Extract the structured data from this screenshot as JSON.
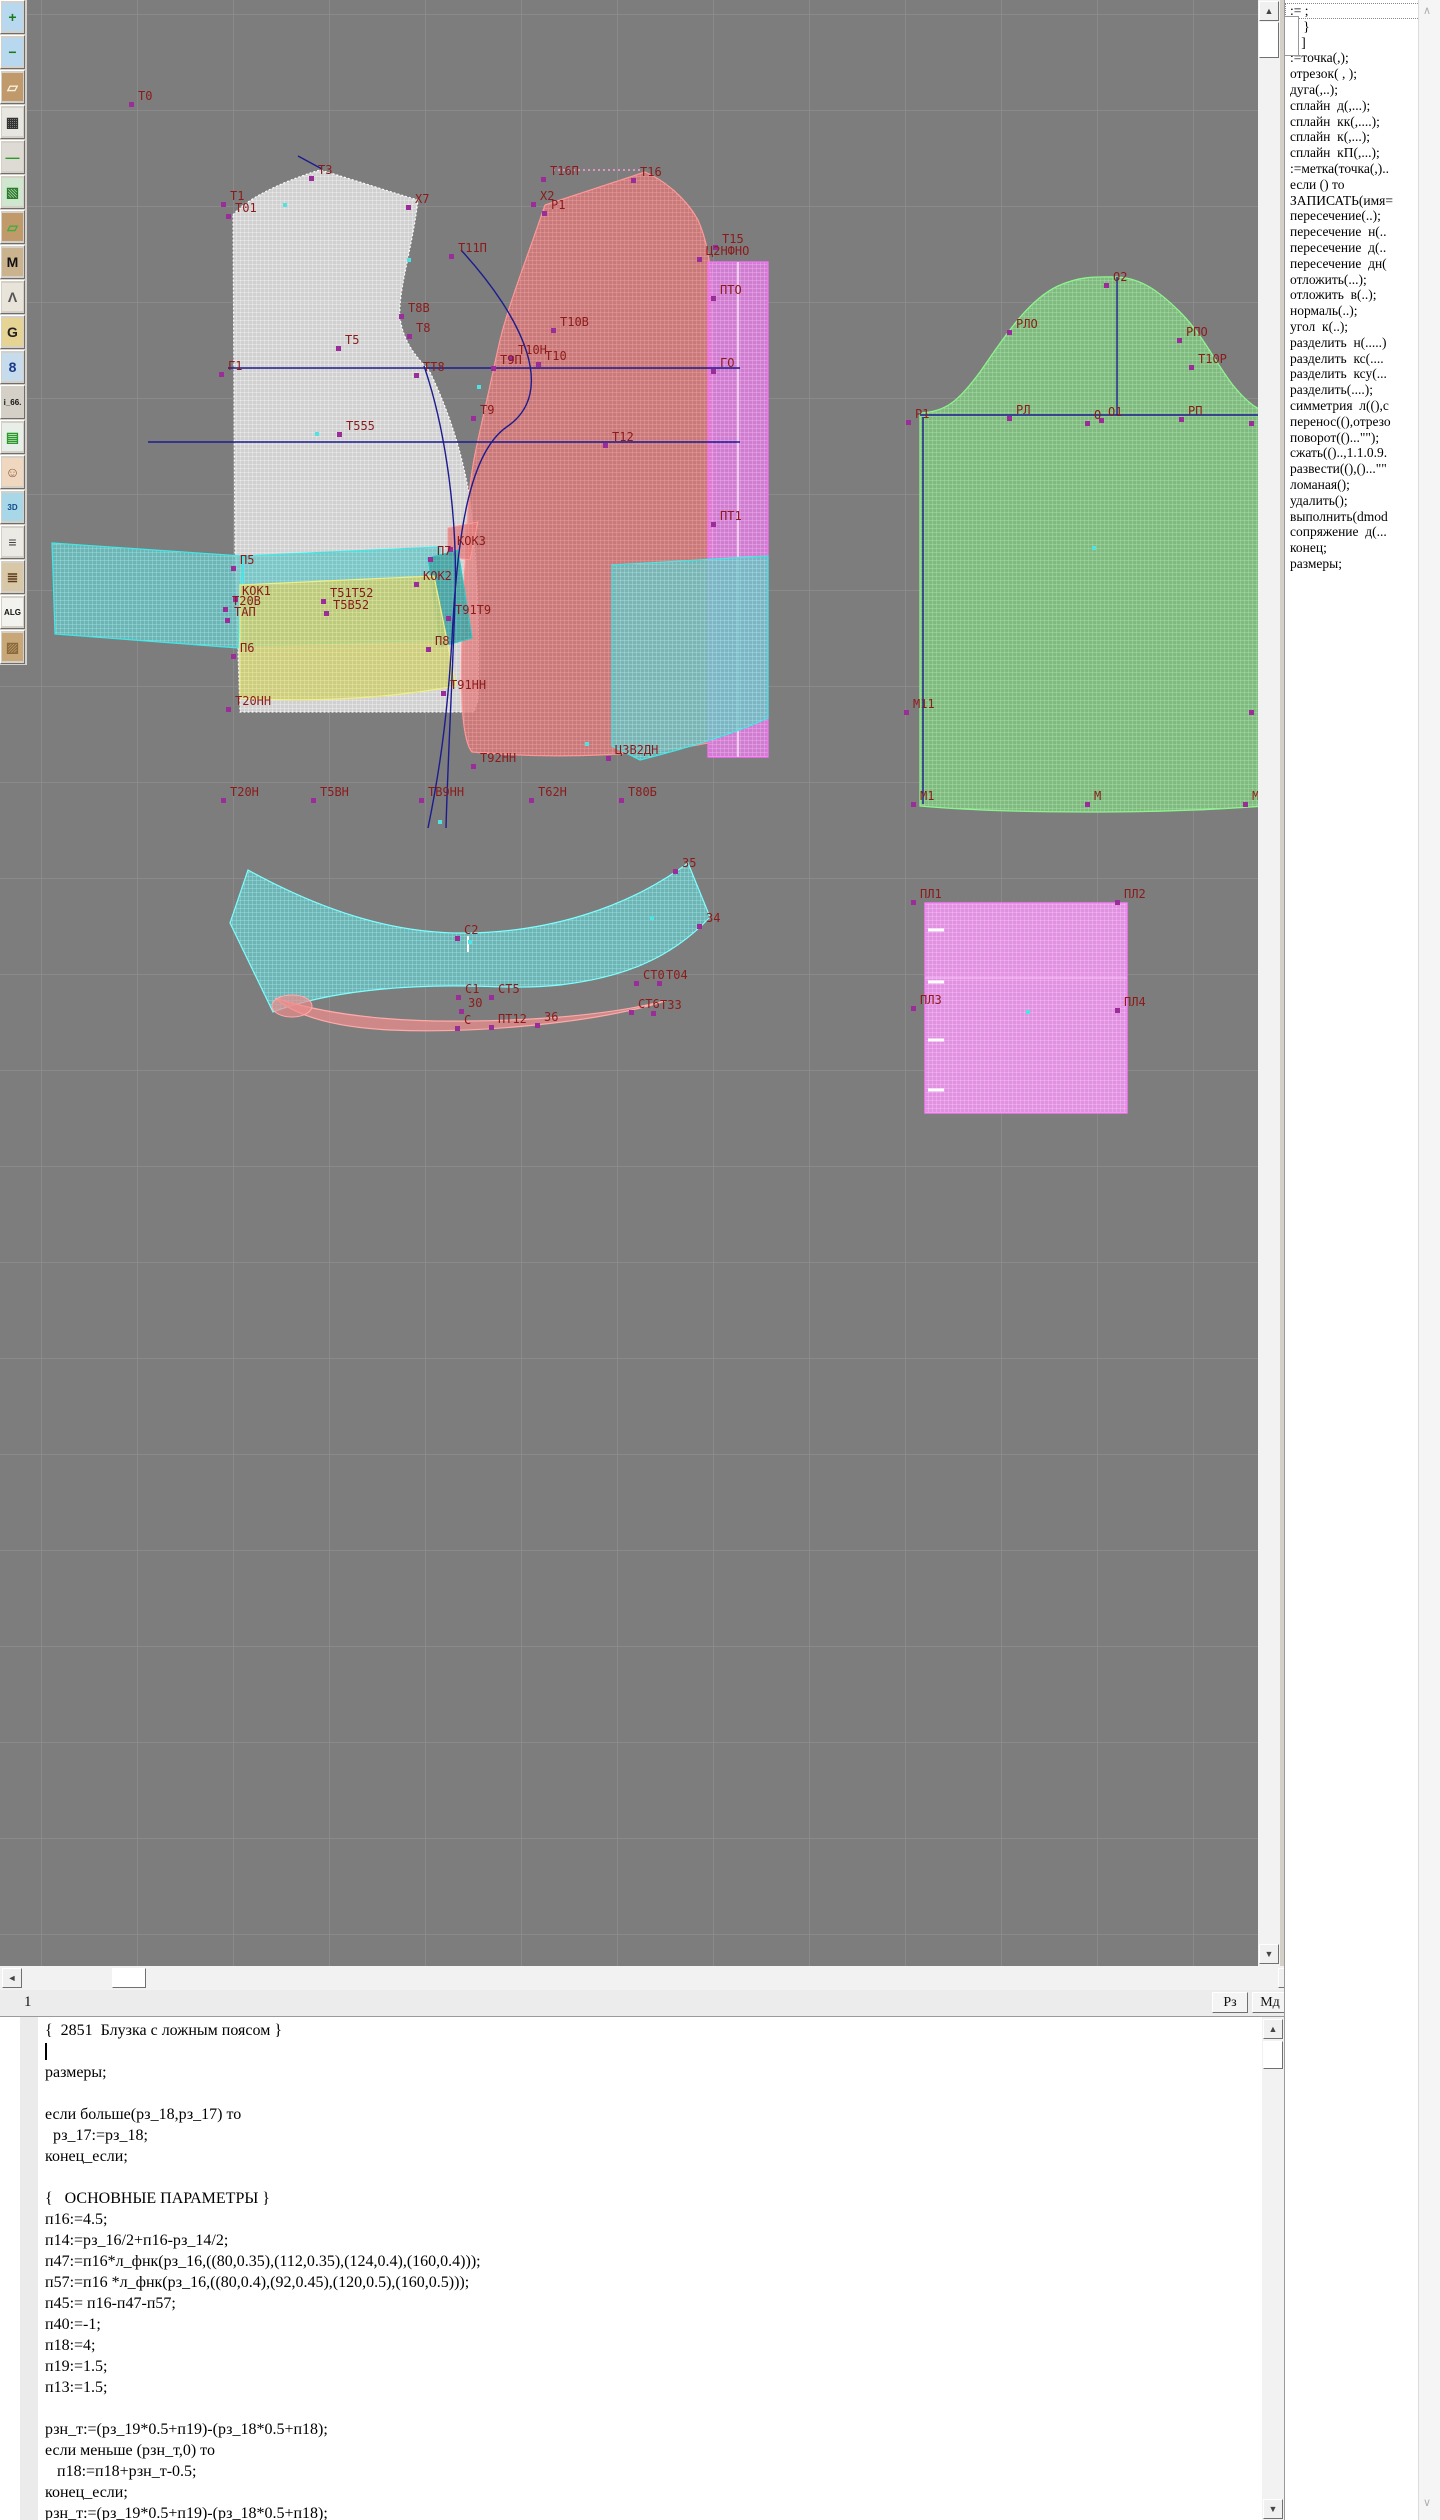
{
  "window": {
    "title": "Грация САПР - конструирование одежды",
    "width": 1440,
    "height": 2520
  },
  "colors": {
    "canvas_bg": "#7d7d7d",
    "grid": "#8a8a8a",
    "label": "#8b1b1b",
    "marker": "#9b2d9b",
    "cyan_dot": "#4fe3e3",
    "blue_line": "#1c1c8f",
    "back_piece": "#f0f0f0",
    "front_piece": "#de7878",
    "sleeve": "#80c480",
    "collar": "#6cc2c2",
    "belt_yellow": "#cccc6c",
    "placket": "#e07ce0",
    "facing": "#ee94ee"
  },
  "toolbar": {
    "items": [
      {
        "name": "zoom-in-icon",
        "label": "+",
        "bg": "#b8d8f0",
        "fg": "#1a7a1a"
      },
      {
        "name": "zoom-out-icon",
        "label": "−",
        "bg": "#b8d8f0",
        "fg": "#1a7a1a"
      },
      {
        "name": "piece-preview-icon",
        "label": "▱",
        "bg": "#c19a6b",
        "fg": "#f5f0e0"
      },
      {
        "name": "grid-icon",
        "label": "▦",
        "bg": "#e8e6e0",
        "fg": "#333333"
      },
      {
        "name": "segment-icon",
        "label": "—",
        "bg": "#dedbd4",
        "fg": "#2a9a2a"
      },
      {
        "name": "sketch-icon",
        "label": "▧",
        "bg": "#cfe6cf",
        "fg": "#2a7a2a"
      },
      {
        "name": "piece-contour-icon",
        "label": "▱",
        "bg": "#c19a6b",
        "fg": "#3fae3f"
      },
      {
        "name": "pattern-m-icon",
        "label": "M",
        "bg": "#cbb390",
        "fg": "#111111"
      },
      {
        "name": "drafting-tools-icon",
        "label": "Λ",
        "bg": "#e8e4da",
        "fg": "#555555"
      },
      {
        "name": "pattern-g-icon",
        "label": "G",
        "bg": "#e6d494",
        "fg": "#222222"
      },
      {
        "name": "blueprint-icon",
        "label": "8",
        "bg": "#c6dcec",
        "fg": "#1a3a8a"
      },
      {
        "name": "i66-button",
        "label": "i_66.",
        "bg": "#d4d0c8",
        "fg": "#111111"
      },
      {
        "name": "table-icon",
        "label": "▤",
        "bg": "#e8efe8",
        "fg": "#2a9a2a"
      },
      {
        "name": "portrait-icon",
        "label": "☺",
        "bg": "#f0d8c0",
        "fg": "#8a5a3a"
      },
      {
        "name": "3d-icon",
        "label": "3D",
        "bg": "#a8d8e8",
        "fg": "#104a8a"
      },
      {
        "name": "list-icon",
        "label": "≡",
        "bg": "#eceae4",
        "fg": "#444444"
      },
      {
        "name": "books-icon",
        "label": "≣",
        "bg": "#d8c8a8",
        "fg": "#5a3a1a"
      },
      {
        "name": "alg-icon",
        "label": "ALG",
        "bg": "#f2f2ee",
        "fg": "#111111"
      },
      {
        "name": "material-icon",
        "label": "▨",
        "bg": "#c8a878",
        "fg": "#8a6a3a"
      }
    ]
  },
  "canvas": {
    "labels": [
      {
        "t": "Т0",
        "x": 138,
        "y": 90
      },
      {
        "t": "Т1",
        "x": 230,
        "y": 190
      },
      {
        "t": "Т01",
        "x": 235,
        "y": 202
      },
      {
        "t": "Т3",
        "x": 318,
        "y": 164
      },
      {
        "t": "Х7",
        "x": 415,
        "y": 193
      },
      {
        "t": "Т11П",
        "x": 458,
        "y": 242
      },
      {
        "t": "Т8В",
        "x": 408,
        "y": 302
      },
      {
        "t": "Т8",
        "x": 416,
        "y": 322
      },
      {
        "t": "Т5",
        "x": 345,
        "y": 334
      },
      {
        "t": "ТТ8",
        "x": 423,
        "y": 361
      },
      {
        "t": "Г1",
        "x": 228,
        "y": 360
      },
      {
        "t": "Т555",
        "x": 346,
        "y": 420
      },
      {
        "t": "Т16П",
        "x": 550,
        "y": 165
      },
      {
        "t": "Т16",
        "x": 640,
        "y": 166
      },
      {
        "t": "Х2",
        "x": 540,
        "y": 190
      },
      {
        "t": "Р1",
        "x": 551,
        "y": 199
      },
      {
        "t": "Т10В",
        "x": 560,
        "y": 316
      },
      {
        "t": "Т10Н",
        "x": 518,
        "y": 344
      },
      {
        "t": "Т10",
        "x": 545,
        "y": 350
      },
      {
        "t": "Т9П",
        "x": 500,
        "y": 354
      },
      {
        "t": "Т9",
        "x": 480,
        "y": 404
      },
      {
        "t": "Т12",
        "x": 612,
        "y": 431
      },
      {
        "t": "Т15",
        "x": 722,
        "y": 233
      },
      {
        "t": "Ц2НФНО",
        "x": 706,
        "y": 245
      },
      {
        "t": "ПТО",
        "x": 720,
        "y": 284
      },
      {
        "t": "ГО",
        "x": 720,
        "y": 357
      },
      {
        "t": "ПТ1",
        "x": 720,
        "y": 510
      },
      {
        "t": "П5",
        "x": 240,
        "y": 554
      },
      {
        "t": "КОК1",
        "x": 242,
        "y": 585
      },
      {
        "t": "Т20В",
        "x": 232,
        "y": 595
      },
      {
        "t": "ТАП",
        "x": 234,
        "y": 606
      },
      {
        "t": "Т51Т52",
        "x": 330,
        "y": 587
      },
      {
        "t": "Т5В52",
        "x": 333,
        "y": 599
      },
      {
        "t": "П7",
        "x": 437,
        "y": 545
      },
      {
        "t": "КОК2",
        "x": 423,
        "y": 570
      },
      {
        "t": "КОК3",
        "x": 457,
        "y": 535
      },
      {
        "t": "Т91Т9",
        "x": 455,
        "y": 604
      },
      {
        "t": "П6",
        "x": 240,
        "y": 642
      },
      {
        "t": "П8",
        "x": 435,
        "y": 635
      },
      {
        "t": "Т91НН",
        "x": 450,
        "y": 679
      },
      {
        "t": "Т20НН",
        "x": 235,
        "y": 695
      },
      {
        "t": "Т92НН",
        "x": 480,
        "y": 752
      },
      {
        "t": "Т20Н",
        "x": 230,
        "y": 786
      },
      {
        "t": "Т5ВН",
        "x": 320,
        "y": 786
      },
      {
        "t": "ТВ9НН",
        "x": 428,
        "y": 786
      },
      {
        "t": "Т62Н",
        "x": 538,
        "y": 786
      },
      {
        "t": "Т80Б",
        "x": 628,
        "y": 786
      },
      {
        "t": "Ц3В2ДН",
        "x": 615,
        "y": 744
      },
      {
        "t": "О2",
        "x": 1113,
        "y": 271
      },
      {
        "t": "РЛО",
        "x": 1016,
        "y": 318
      },
      {
        "t": "РПО",
        "x": 1186,
        "y": 326
      },
      {
        "t": "Т10Р",
        "x": 1198,
        "y": 353
      },
      {
        "t": "Р1",
        "x": 915,
        "y": 408
      },
      {
        "t": "РЛ",
        "x": 1016,
        "y": 404
      },
      {
        "t": "О",
        "x": 1094,
        "y": 409
      },
      {
        "t": "О1",
        "x": 1108,
        "y": 406
      },
      {
        "t": "РП",
        "x": 1188,
        "y": 405
      },
      {
        "t": "Р",
        "x": 1258,
        "y": 409
      },
      {
        "t": "М11",
        "x": 913,
        "y": 698
      },
      {
        "t": "М",
        "x": 1258,
        "y": 698
      },
      {
        "t": "М1",
        "x": 920,
        "y": 790
      },
      {
        "t": "М",
        "x": 1094,
        "y": 790
      },
      {
        "t": "МР",
        "x": 1252,
        "y": 790
      },
      {
        "t": "35",
        "x": 682,
        "y": 857
      },
      {
        "t": "34",
        "x": 706,
        "y": 912
      },
      {
        "t": "С2",
        "x": 464,
        "y": 924
      },
      {
        "t": "С1",
        "x": 465,
        "y": 983
      },
      {
        "t": "СТ5",
        "x": 498,
        "y": 983
      },
      {
        "t": "СТ0",
        "x": 643,
        "y": 969
      },
      {
        "t": "Т04",
        "x": 666,
        "y": 969
      },
      {
        "t": "30",
        "x": 468,
        "y": 997
      },
      {
        "t": "СТ6",
        "x": 638,
        "y": 998
      },
      {
        "t": "Т33",
        "x": 660,
        "y": 999
      },
      {
        "t": "С",
        "x": 464,
        "y": 1014
      },
      {
        "t": "ПТ12",
        "x": 498,
        "y": 1013
      },
      {
        "t": "36",
        "x": 544,
        "y": 1011
      },
      {
        "t": "ПЛ1",
        "x": 920,
        "y": 888
      },
      {
        "t": "ПЛ2",
        "x": 1124,
        "y": 888
      },
      {
        "t": "ПЛ3",
        "x": 920,
        "y": 994
      },
      {
        "t": "ПЛ4",
        "x": 1124,
        "y": 996
      }
    ],
    "dots": [
      [
        283,
        203
      ],
      [
        407,
        258
      ],
      [
        477,
        385
      ],
      [
        315,
        432
      ],
      [
        1092,
        546
      ],
      [
        1026,
        1010
      ],
      [
        650,
        916
      ],
      [
        438,
        820
      ],
      [
        585,
        742
      ],
      [
        468,
        940
      ]
    ]
  },
  "panel": {
    "commands": [
      ":= ;",
      "{  }",
      "[  ]",
      ":=точка(,);",
      "отрезок( , );",
      "дуга(,..);",
      "сплайн  д(,...);",
      "сплайн  кк(,....);",
      "сплайн  к(,...);",
      "сплайн  кП(,...);",
      ":=метка(точка(,)..",
      "если () то",
      "ЗАПИСАТЬ(имя=",
      "пересечение(..);",
      "пересечение  н(..",
      "пересечение  д(..",
      "пересечение  дн(",
      "отложить(...);",
      "отложить  в(..);",
      "нормаль(..);",
      "угол  к(..);",
      "разделить  н(.....)",
      "разделить  кс(....",
      "разделить  ксу(...",
      "разделить(....);",
      "симметрия  л((),с",
      "перенос((),отрезо",
      "поворот(()...\"\");",
      "сжать(()..,1.1.0.9.",
      "развести((),()...\"\"",
      "ломаная();",
      "удалить();",
      "выполнить(dmod",
      "сопряжение  д(...",
      "конец;",
      "размеры;"
    ]
  },
  "statusbar": {
    "left": "1",
    "buttons": [
      "Рз",
      "Мд"
    ]
  },
  "editor": {
    "caret_line": 1,
    "lines": [
      "{  2851  Блузка с ложным поясом }",
      "",
      "размеры;",
      "",
      "если больше(рз_18,рз_17) то",
      "  рз_17:=рз_18;",
      "конец_если;",
      "",
      "{   ОСНОВНЫЕ ПАРАМЕТРЫ }",
      "п16:=4.5;",
      "п14:=рз_16/2+п16-рз_14/2;",
      "п47:=п16*л_фнк(рз_16,((80,0.35),(112,0.35),(124,0.4),(160,0.4)));",
      "п57:=п16 *л_фнк(рз_16,((80,0.4),(92,0.45),(120,0.5),(160,0.5)));",
      "п45:= п16-п47-п57;",
      "п40:=-1;",
      "п18:=4;",
      "п19:=1.5;",
      "п13:=1.5;",
      "",
      "рзн_т:=(рз_19*0.5+п19)-(рз_18*0.5+п18);",
      "если меньше (рзн_т,0) то",
      "   п18:=п18+рзн_т-0.5;",
      "конец_если;",
      "рзн_т:=(рз_19*0.5+п19)-(рз_18*0.5+п18);"
    ]
  }
}
